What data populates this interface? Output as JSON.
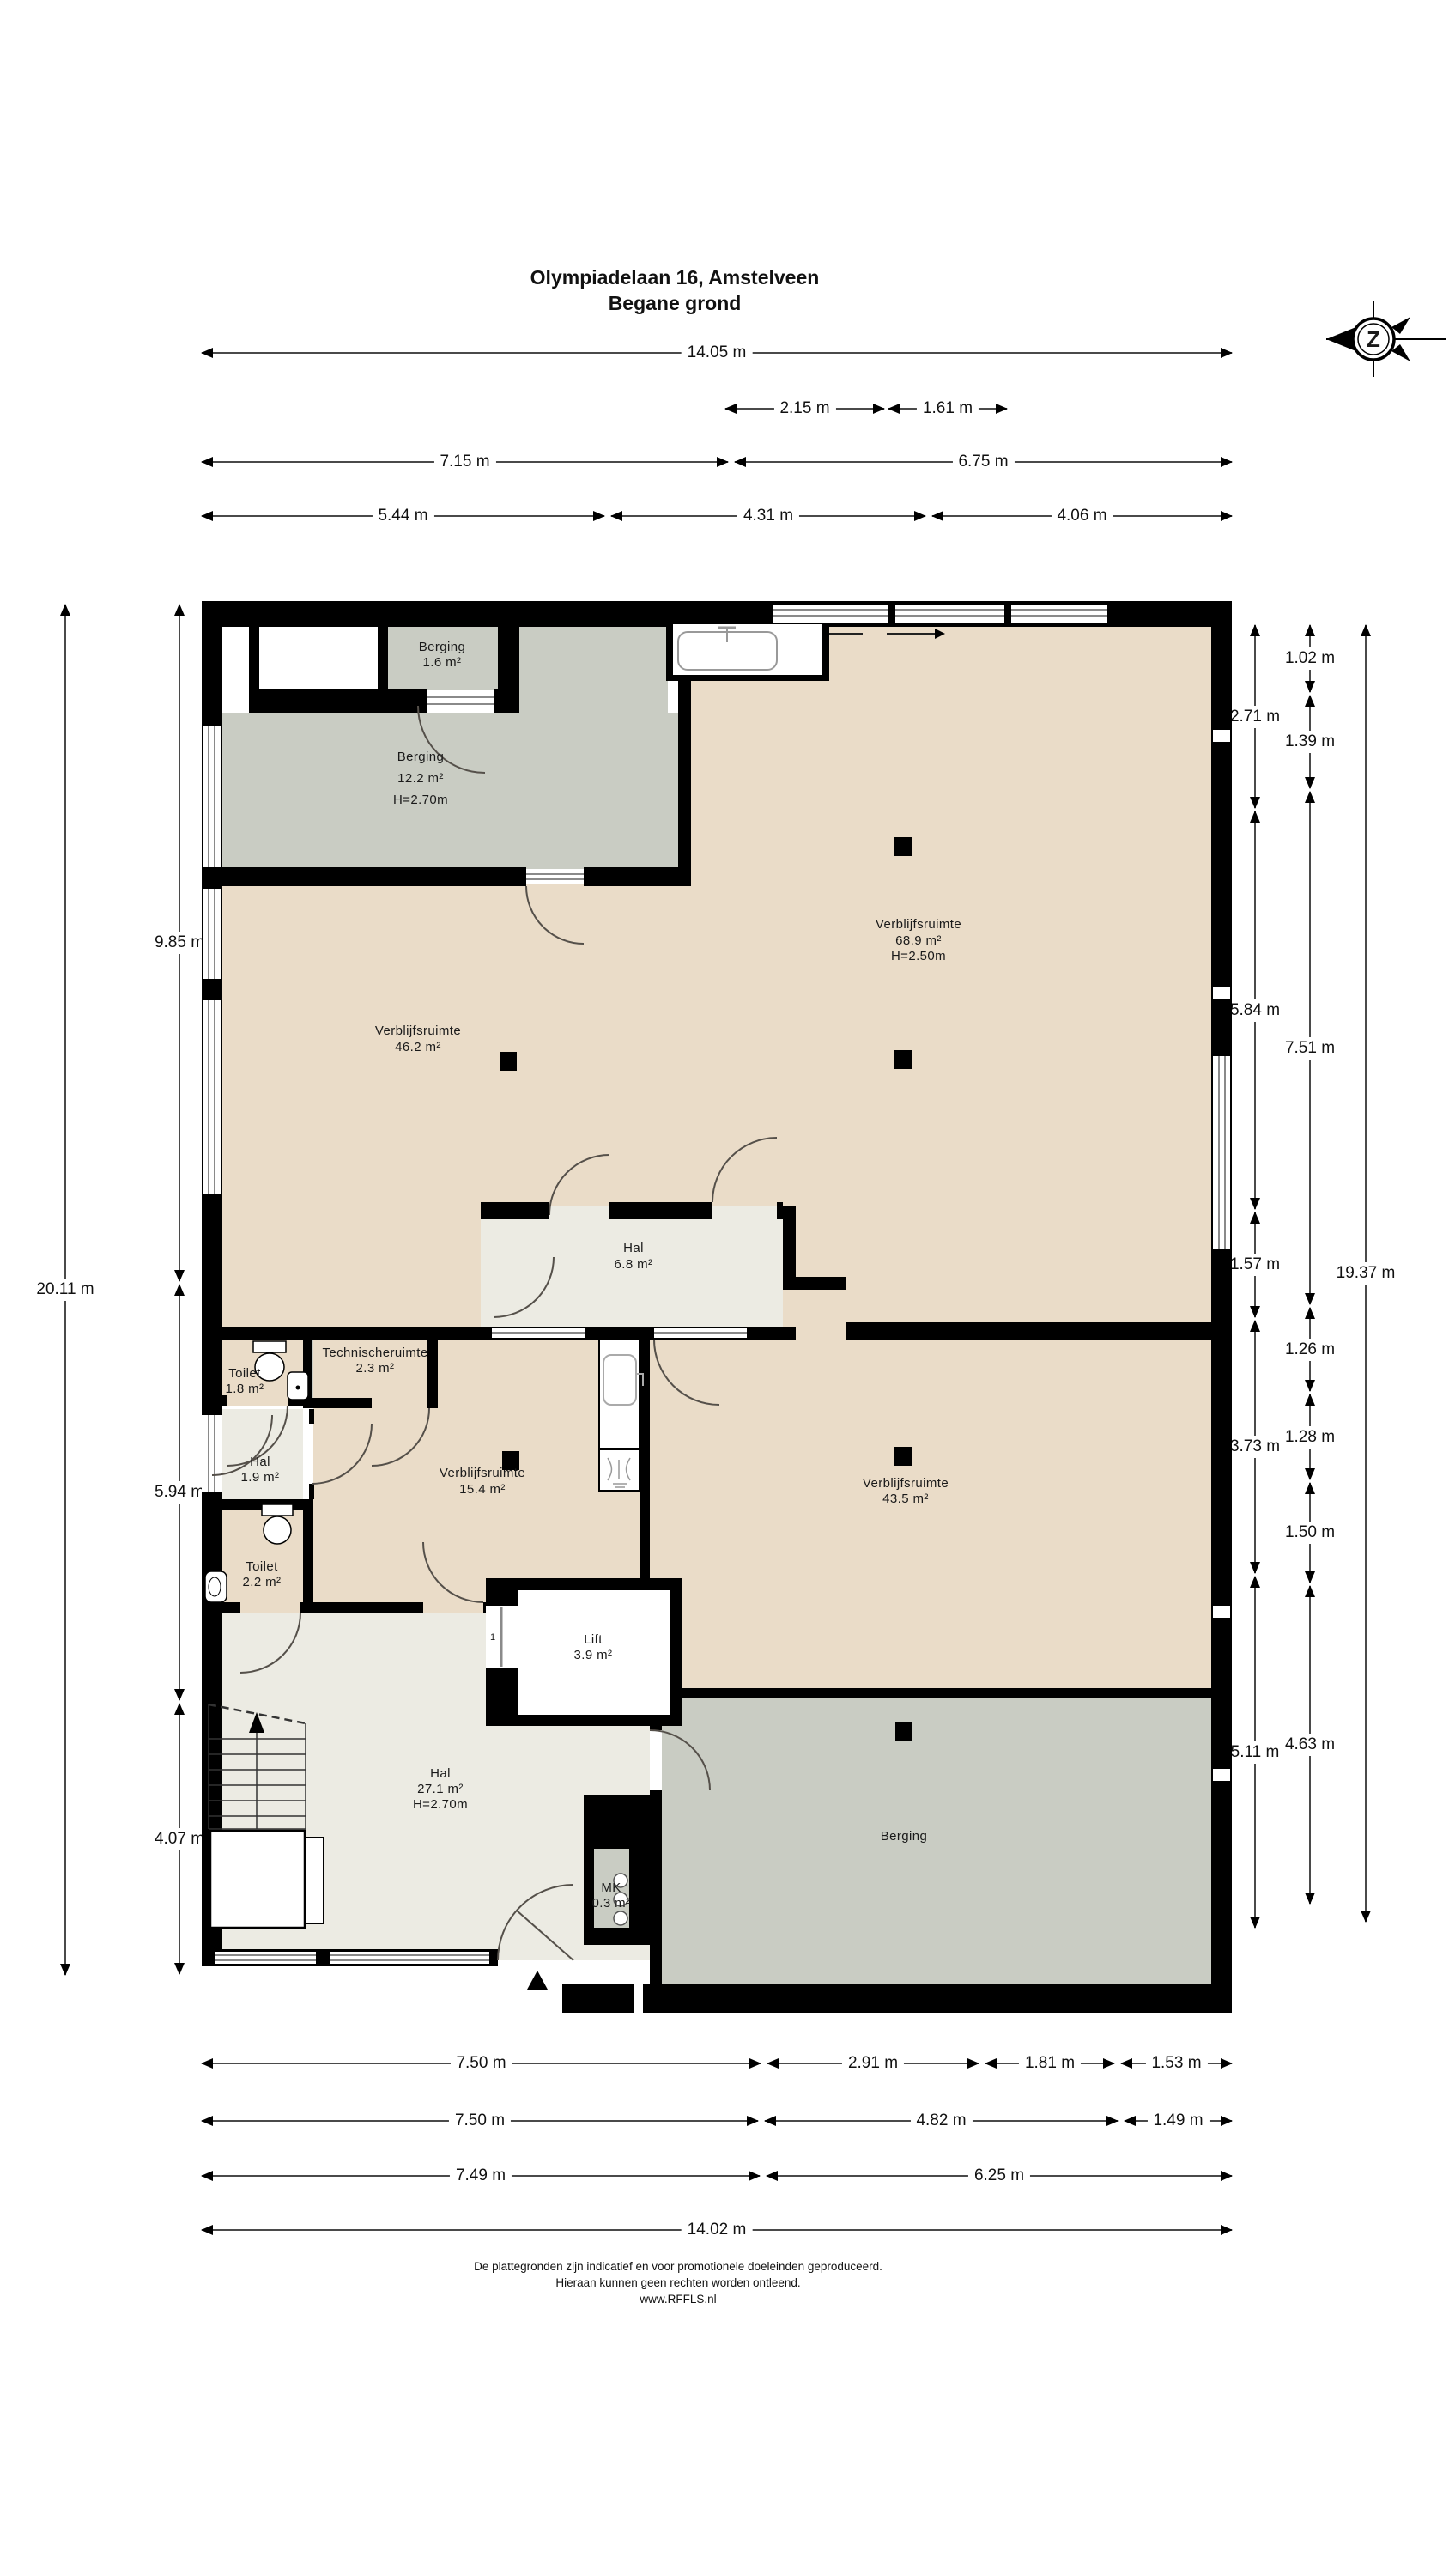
{
  "title": {
    "line1": "Olympiadelaan 16, Amstelveen",
    "line2": "Begane grond"
  },
  "compass": {
    "label": "Z"
  },
  "rooms": {
    "berging_top": {
      "name": "Berging",
      "area": "1.6 m²"
    },
    "berging_left": {
      "name": "Berging",
      "area": "12.2 m²",
      "height": "H=2.70m"
    },
    "verblijf_46": {
      "name": "Verblijfsruimte",
      "area": "46.2 m²"
    },
    "verblijf_68": {
      "name": "Verblijfsruimte",
      "area": "68.9 m²",
      "height": "H=2.50m"
    },
    "hal_6": {
      "name": "Hal",
      "area": "6.8 m²"
    },
    "toilet_1": {
      "name": "Toilet",
      "area": "1.8 m²"
    },
    "technische": {
      "name": "Technischeruimte",
      "area": "2.3 m²"
    },
    "hal_1": {
      "name": "Hal",
      "area": "1.9 m²"
    },
    "verblijf_15": {
      "name": "Verblijfsruimte",
      "area": "15.4 m²"
    },
    "verblijf_43": {
      "name": "Verblijfsruimte",
      "area": "43.5 m²"
    },
    "toilet_2": {
      "name": "Toilet",
      "area": "2.2 m²"
    },
    "lift": {
      "name": "Lift",
      "area": "3.9 m²",
      "door_label": "1"
    },
    "hal_27": {
      "name": "Hal",
      "area": "27.1 m²",
      "height": "H=2.70m"
    },
    "mk": {
      "name": "MK",
      "area": "0.3 m²"
    },
    "berging_bottom": {
      "name": "Berging"
    }
  },
  "dimensions": {
    "top": [
      [
        "14.05 m"
      ],
      [
        "2.15 m",
        "1.61 m"
      ],
      [
        "7.15 m",
        "6.75 m"
      ],
      [
        "5.44 m",
        "4.31 m",
        "4.06 m"
      ]
    ],
    "bottom": [
      [
        "7.50 m",
        "2.91 m",
        "1.81 m",
        "1.53 m"
      ],
      [
        "7.50 m",
        "4.82 m",
        "1.49 m"
      ],
      [
        "7.49 m",
        "6.25 m"
      ],
      [
        "14.02 m"
      ]
    ],
    "left_inner": [
      "9.85 m",
      "5.94 m",
      "4.07 m"
    ],
    "left_outer": [
      "20.11 m"
    ],
    "right_col1": [
      "2.71 m",
      "5.84 m",
      "1.57 m",
      "3.73 m",
      "5.11 m"
    ],
    "right_col2": [
      "1.02 m",
      "1.39 m",
      "7.51 m",
      "1.26 m",
      "1.28 m",
      "1.50 m",
      "4.63 m"
    ],
    "right_col3": [
      "19.37 m"
    ]
  },
  "footer": {
    "line1": "De plattegronden zijn indicatief en voor promotionele doeleinden geproduceerd.",
    "line2": "Hieraan kunnen geen rechten worden ontleend.",
    "line3": "www.RFFLS.nl"
  },
  "colors": {
    "wall": "#000000",
    "room_beige": "#EADCC8",
    "room_gray": "#C9CCC3",
    "room_light": "#ECEBE3",
    "dim_line": "#4a4a4a",
    "door_arc": "#55504a"
  }
}
